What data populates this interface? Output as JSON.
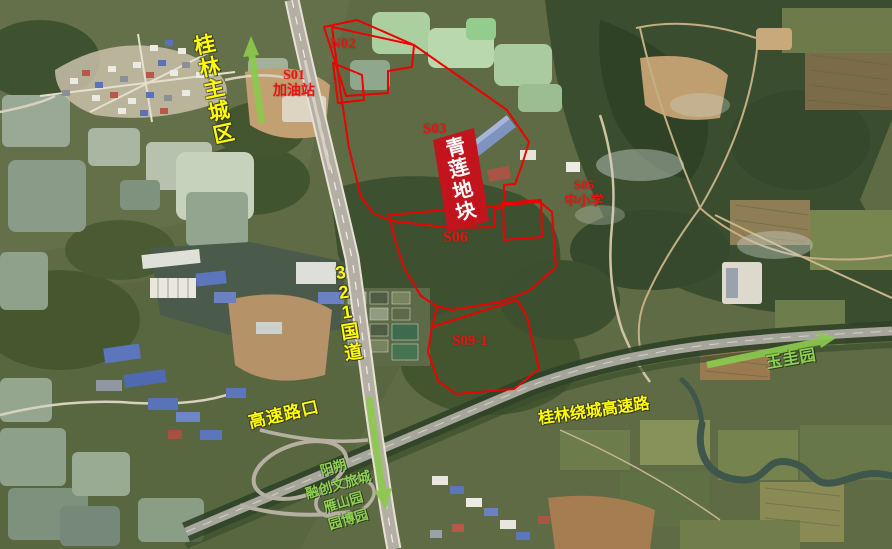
{
  "annotations": {
    "project": {
      "name": "青莲地块",
      "chars": [
        "青",
        "莲",
        "地",
        "块"
      ]
    },
    "parcels": {
      "s01": {
        "code": "S01",
        "name": "加油站"
      },
      "n02": {
        "code": "N02"
      },
      "s03": {
        "code": "S03"
      },
      "s05": {
        "code": "S05",
        "name": "中小学"
      },
      "s06": {
        "code": "S06"
      },
      "s09_1": {
        "code": "S09-1"
      }
    },
    "roads": {
      "g321": {
        "name": "321国道",
        "chars": [
          "3",
          "2",
          "1",
          "国",
          "道"
        ]
      },
      "ring_highway": {
        "name": "桂林绕城高速路"
      },
      "highway_exit": {
        "name": "高速路口"
      }
    },
    "directions": {
      "city": {
        "name": "桂林主城区",
        "chars": [
          "桂",
          "林",
          "主",
          "城",
          "区"
        ],
        "arrow": "up"
      },
      "yuguiyuan": {
        "name": "玉圭园",
        "arrow": "up-right"
      },
      "south": {
        "lines": [
          "阳朔",
          "融创文旅城",
          "雁山园",
          "园博园"
        ],
        "arrow": "down"
      }
    }
  },
  "colors": {
    "parcel_outline": "#ec0000",
    "project_box_bg": "#c2141d",
    "project_box_text": "#ffffff",
    "label_red": "#ee1111",
    "label_yellow": "#ffff00",
    "label_green": "#8fd053",
    "arrow_green": "#8cc94e"
  }
}
